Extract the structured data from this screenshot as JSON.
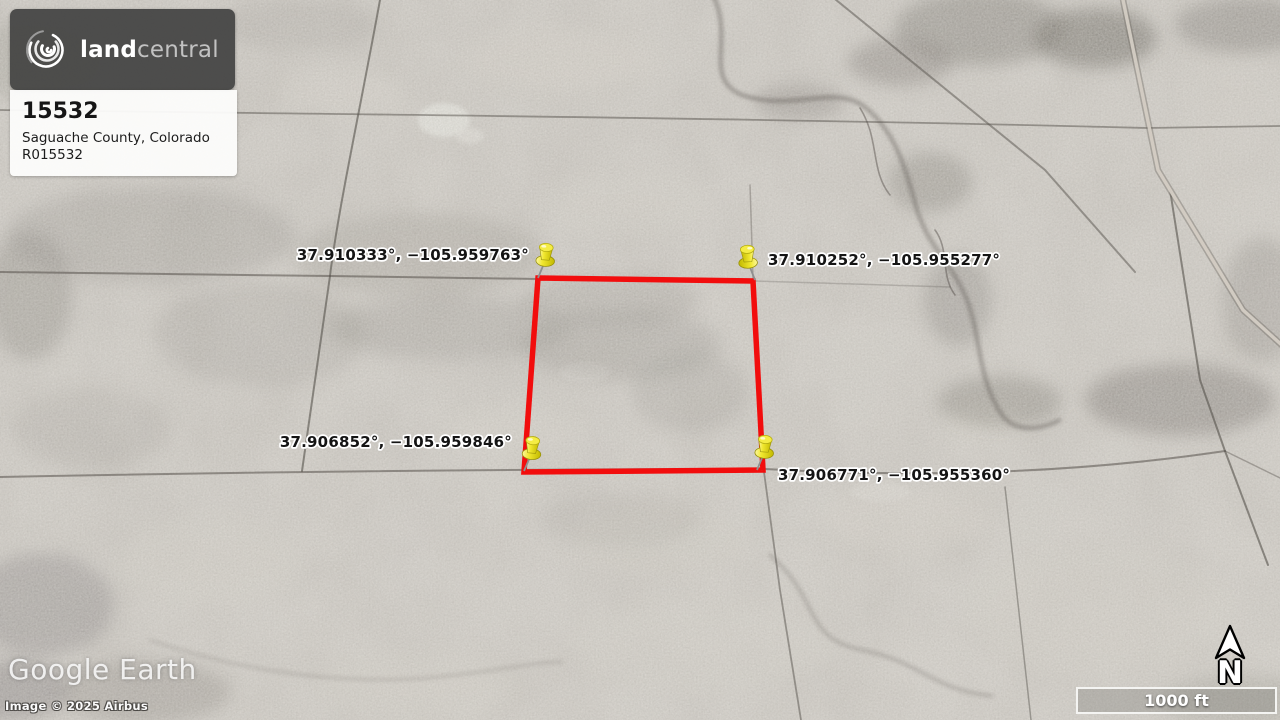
{
  "brand_card": {
    "brand_land": "land",
    "brand_central": "central",
    "parcel_number": "15532",
    "location": "Saguache County, Colorado",
    "reference": "R015532"
  },
  "pins": [
    {
      "id": "nw",
      "label": "37.910333°, −105.959763°"
    },
    {
      "id": "ne",
      "label": "37.910252°, −105.955277°"
    },
    {
      "id": "sw",
      "label": "37.906852°, −105.959846°"
    },
    {
      "id": "se",
      "label": "37.906771°, −105.955360°"
    }
  ],
  "watermark": {
    "brand": "Google Earth",
    "attribution": "Image © 2025 Airbus"
  },
  "map_controls": {
    "north_label": "N",
    "scale_label": "1000 ft"
  },
  "colors": {
    "boundary_red": "#f20d0d",
    "pin_yellow": "#f1e830",
    "card_dark": "#484847",
    "terrain_base": "#c2bcb4"
  }
}
